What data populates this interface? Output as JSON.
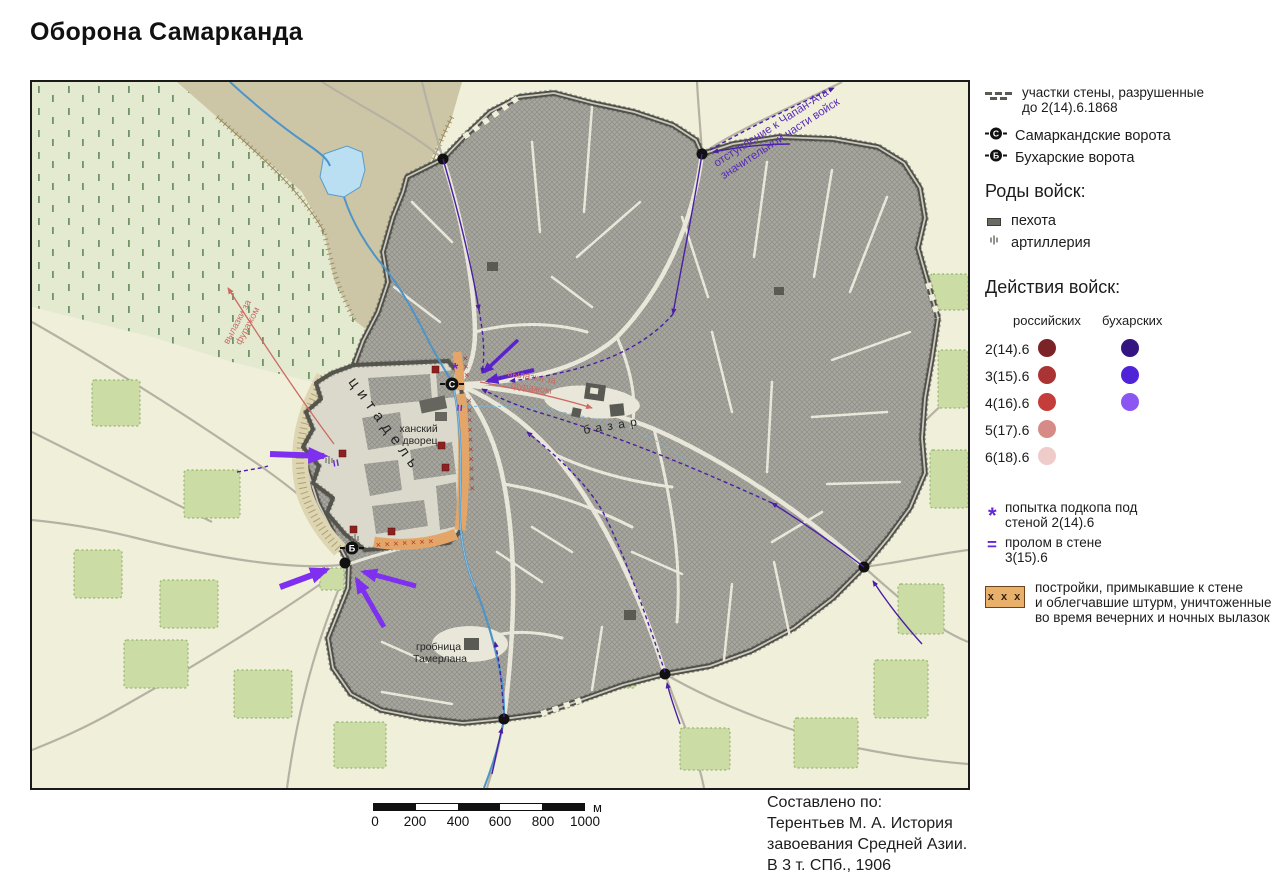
{
  "title": "Оборона Самарканда",
  "legend": {
    "ruined_wall": {
      "line1": "участки стены, разрушенные",
      "line2": "до 2(14).6.1868"
    },
    "gate_samarkand": {
      "letter": "С",
      "label": "Самаркандские ворота"
    },
    "gate_bukhara": {
      "letter": "Б",
      "label": "Бухарские ворота"
    },
    "troop_types_header": "Роды войск:",
    "infantry_label": "пехота",
    "artillery_label": "артиллерия",
    "actions_header": "Действия войск:",
    "col_russian": "российских",
    "col_bukharan": "бухарских",
    "action_rows": [
      {
        "date": "2(14).6",
        "russian_color": "#7b2327",
        "bukharan_color": "#331480"
      },
      {
        "date": "3(15).6",
        "russian_color": "#aa3434",
        "bukharan_color": "#5023d9"
      },
      {
        "date": "4(16).6",
        "russian_color": "#c53d3a",
        "bukharan_color": "#8b56f1"
      },
      {
        "date": "5(17).6",
        "russian_color": "#d78b87",
        "bukharan_color": null
      },
      {
        "date": "6(18).6",
        "russian_color": "#efcbca",
        "bukharan_color": null
      }
    ],
    "mine_symbol": "*",
    "mine_label": {
      "line1": "попытка подкопа под",
      "line2": "стеной 2(14).6"
    },
    "breach_symbol": "=",
    "breach_label": {
      "line1": "пролом в стене",
      "line2": "3(15).6"
    },
    "buildings_marks": "х х х",
    "buildings_label": {
      "line1": "постройки, примыкавшие к стене",
      "line2": "и облегчавшие штурм, уничтоженные",
      "line3": "во время вечерних и ночных вылазок"
    }
  },
  "map_labels": {
    "citadel": "цитадель",
    "palace": {
      "line1": "ханский",
      "line2": "дворец"
    },
    "bazaar": "базар",
    "tomb": {
      "line1": "гробница",
      "line2": "Тамерлана"
    },
    "retreat": {
      "line1": "отступление к Чапан-Ата",
      "line2": "значительной части войск"
    },
    "sortie": {
      "line1": "вылазки за",
      "line2": "фуражом"
    }
  },
  "map_marks": {
    "east_strip": "××××××××××",
    "south_strip": "×××××××",
    "north_strip": "×××"
  },
  "scale_bar": {
    "ticks": [
      "0",
      "200",
      "400",
      "600",
      "800",
      "1000"
    ],
    "unit": "м"
  },
  "attribution": {
    "line1": "Составлено по:",
    "line2": "Терентьев М. А. История",
    "line3": "завоевания Средней Азии.",
    "line4": "В 3 т. СПб., 1906"
  },
  "colors": {
    "map_background": "#f0efda",
    "city_blocks": "#a7a7a0",
    "wall": "#50504a",
    "field_green": "#e3ead0",
    "garden_green": "#cbdda4",
    "water_blue": "#4e94c8",
    "attack_arrow_violet": "#7e2ff0",
    "movement_purple": "#4a1fa5",
    "sortie_pink": "#cc6a64",
    "destroyed_strip_orange": "#e3a668",
    "infantry_red": "#8e2020"
  }
}
